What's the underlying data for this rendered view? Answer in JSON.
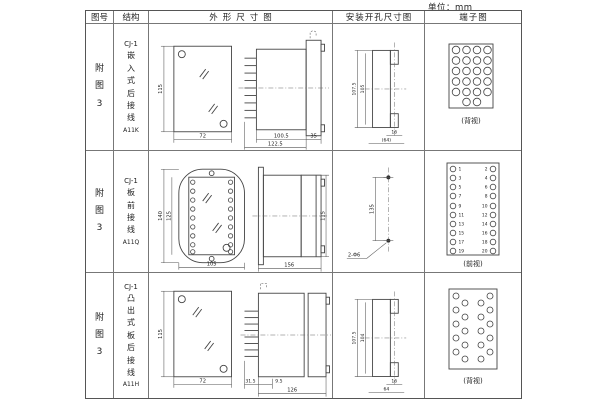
{
  "unit_label": "单位：mm",
  "table": {
    "headers": {
      "fig_no": "图号",
      "structure": "结构",
      "outline": "外形尺寸图",
      "install": "安装开孔尺寸图",
      "terminal": "端子图"
    },
    "rows": [
      {
        "fig_no": "附图3",
        "structure": {
          "model": "CJ-1",
          "desc": "嵌入式后接线",
          "code": "A11K"
        },
        "outline": {
          "front_height": "115",
          "front_width": "72",
          "body_len": "100.5",
          "total_len": "122.5",
          "flange_w": "35"
        },
        "install": {
          "outer_v": "107.5",
          "inner_v": "105",
          "slot_w": "16",
          "span_w": "(64)"
        },
        "terminal": {
          "view": "(背视)"
        }
      },
      {
        "fig_no": "附图3",
        "structure": {
          "model": "CJ-1",
          "desc": "板前接线",
          "code": "A11Q"
        },
        "outline": {
          "outer_v": "140",
          "inner_v": "125",
          "front_width": "105",
          "depth": "156",
          "side_h": "115"
        },
        "install": {
          "span_v": "135",
          "holes_label": "2-Φ6"
        },
        "terminal": {
          "view": "(前视)",
          "left": [
            "1",
            "3",
            "5",
            "7",
            "9",
            "11",
            "13",
            "15",
            "17",
            "19"
          ],
          "right": [
            "2",
            "4",
            "6",
            "8",
            "10",
            "12",
            "14",
            "16",
            "18",
            "20"
          ]
        }
      },
      {
        "fig_no": "附图3",
        "structure": {
          "model": "CJ-1",
          "desc": "凸出式板后接线",
          "code": "A11H"
        },
        "outline": {
          "front_height": "115",
          "front_width": "72",
          "pin_len": "31.5",
          "step_len": "9.5",
          "total_len": "126"
        },
        "install": {
          "outer_v": "107.5",
          "inner_v": "104",
          "slot_w": "16",
          "span_w": "64"
        },
        "terminal": {
          "view": "(背视)"
        }
      }
    ]
  }
}
